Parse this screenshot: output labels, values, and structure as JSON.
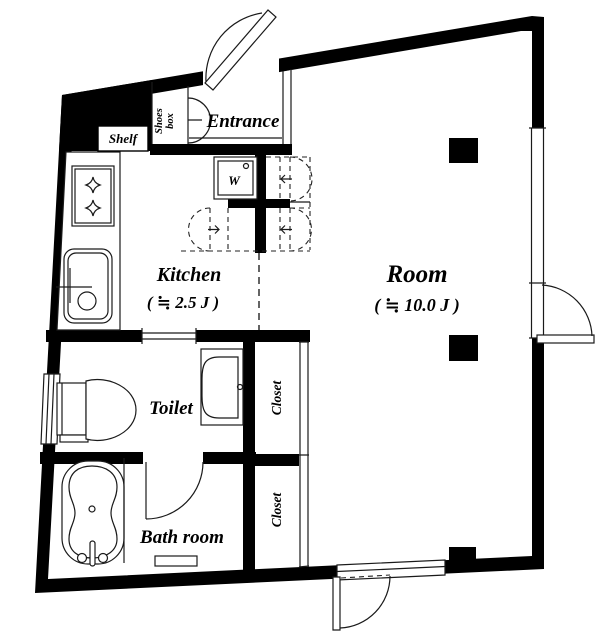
{
  "floor_plan": {
    "labels": {
      "entrance": "Entrance",
      "shelf": "Shelf",
      "shoes_line1": "Shoes",
      "shoes_line2": "box",
      "washer": "W",
      "kitchen": "Kitchen",
      "kitchen_size": "( ≒ 2.5 J )",
      "room": "Room",
      "room_size": "( ≒ 10.0 J )",
      "toilet": "Toilet",
      "bathroom": "Bath room",
      "closet_upper": "Closet",
      "closet_lower": "Closet"
    },
    "colors": {
      "wall": "#000000",
      "line": "#1a1a1a",
      "background": "#ffffff"
    }
  }
}
